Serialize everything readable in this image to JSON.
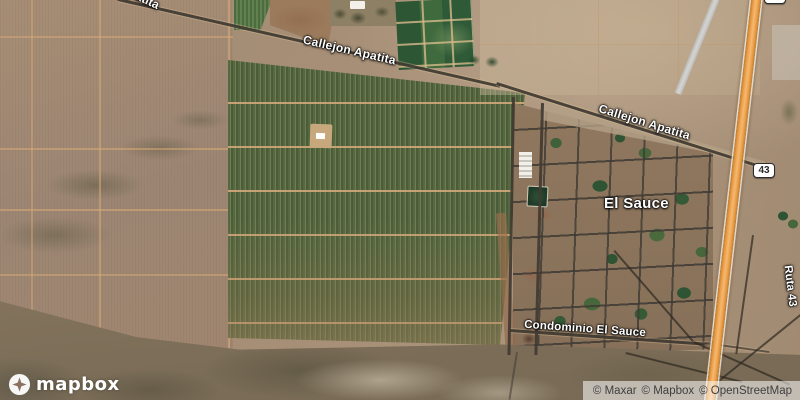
{
  "labels": {
    "road_partial_top": "Apatita",
    "callejon_apatita_west": "Callejon Apatita",
    "callejon_apatita_east": "Callejon Apatita",
    "place_el_sauce": "El Sauce",
    "condominio_el_sauce": "Condominio El Sauce",
    "ruta_43": "Ruta 43",
    "route_shield": "43",
    "route_shield_top": "43"
  },
  "branding": {
    "logo_text": "mapbox"
  },
  "attribution": {
    "maxar": "© Maxar",
    "mapbox": "© Mapbox",
    "openstreetmap": "© OpenStreetMap"
  },
  "colors": {
    "highway_orange": "#eb9f48",
    "field_green": "#5d7347",
    "terrain_tan": "#a18a74",
    "village_brown": "#8d7763",
    "road_dark": "#413b33",
    "label_text": "#ffffff"
  }
}
